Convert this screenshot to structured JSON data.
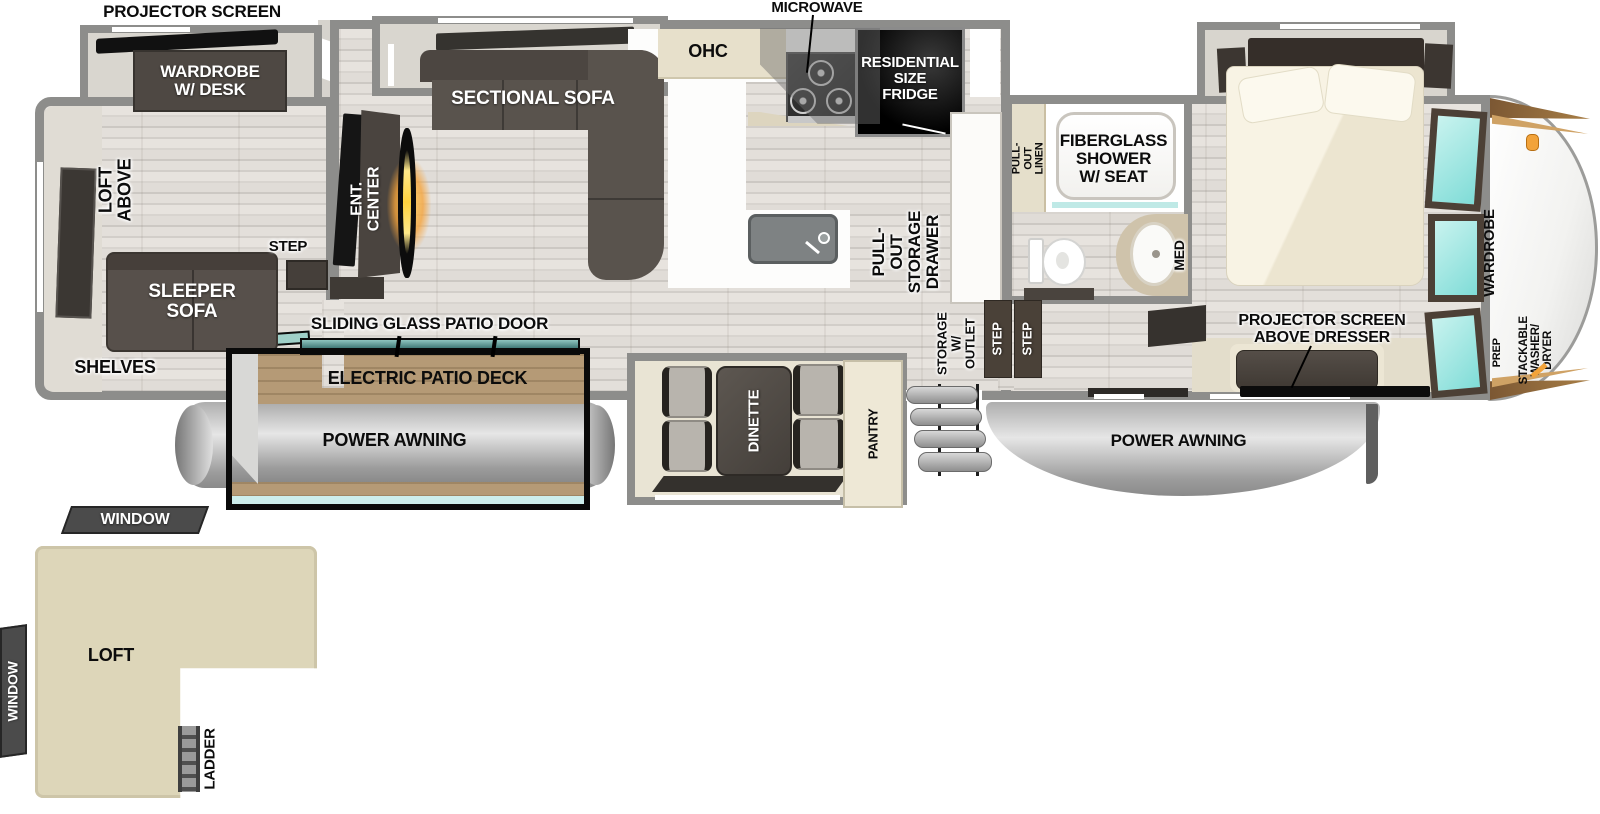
{
  "rear_room": {
    "projector_screen": "PROJECTOR SCREEN",
    "wardrobe_desk": "WARDROBE\nW/ DESK",
    "loft_above": "LOFT ABOVE",
    "sleeper_sofa": "SLEEPER\nSOFA",
    "shelves": "SHELVES",
    "step": "STEP"
  },
  "living": {
    "ent_center": "ENT. CENTER",
    "sectional_sofa": "SECTIONAL SOFA"
  },
  "kitchen": {
    "ohc": "OHC",
    "microwave": "MICROWAVE",
    "fridge": "RESIDENTIAL\nSIZE\nFRIDGE",
    "pull_out_storage_drawer": "PULL-OUT\nSTORAGE\nDRAWER",
    "pantry": "PANTRY"
  },
  "patio": {
    "sliding_glass_door": "SLIDING GLASS PATIO DOOR",
    "electric_patio_deck": "ELECTRIC PATIO DECK",
    "power_awning": "POWER AWNING",
    "window_top": "WINDOW",
    "window_side": "WINDOW"
  },
  "dinette": {
    "label": "DINETTE"
  },
  "entry": {
    "storage_outlet": "STORAGE\nW/ OUTLET",
    "step_upper": "STEP",
    "step_lower": "STEP"
  },
  "bathroom": {
    "pull_out_linen": "PULL-OUT\nLINEN",
    "shower": "FIBERGLASS\nSHOWER\nW/ SEAT",
    "med": "MED"
  },
  "bedroom": {
    "projector_screen_dresser": "PROJECTOR SCREEN\nABOVE DRESSER",
    "wardrobe": "WARDROBE",
    "power_awning": "POWER AWNING"
  },
  "front_cap": {
    "washer_dryer": "STACKABLE\nWASHER/\nDRYER",
    "prep": "PREP"
  },
  "loft": {
    "label": "LOFT",
    "ladder": "LADDER"
  },
  "colors": {
    "wall": "#8d8d8b",
    "floor": "#dcd8d3",
    "furniture_dark": "#57504b",
    "cabinet_cream": "#e7e0cb",
    "glass_teal": "#7fdcd7",
    "deck_wood": "#b59a76",
    "awning_gray": "#c2c2c2",
    "loft_beige": "#ddd6b9",
    "fireplace_orange": "#f2a33a",
    "label_black": "#0c0c0c",
    "label_white": "#ffffff"
  }
}
